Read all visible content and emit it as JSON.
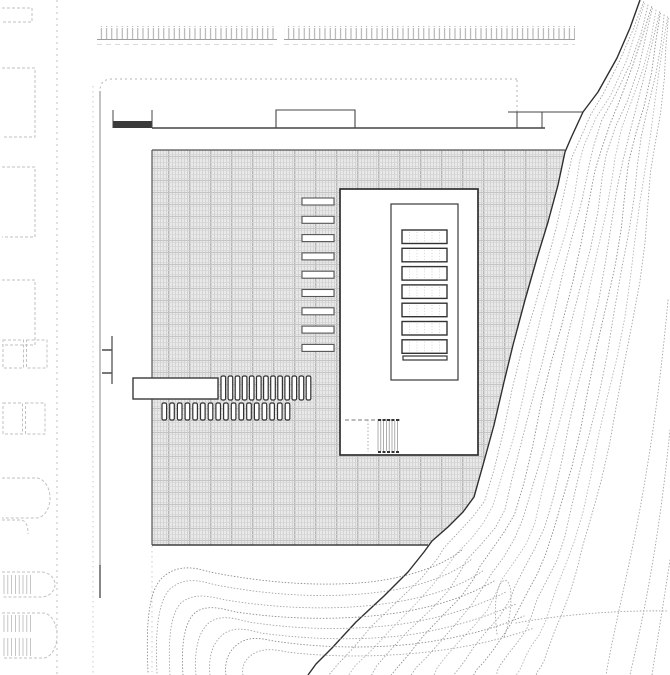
{
  "meta": {
    "label": "architectural-site-plan",
    "canvas": {
      "w": 670,
      "h": 675
    }
  },
  "colors": {
    "ink_dark": "#2f2f2f",
    "ink_mid": "#555555",
    "ink_wall": "#3a3a3a",
    "light_line": "#c2c2c2",
    "faint_line": "#cfcfcf",
    "edge_line": "#8f8f8f",
    "contour": "#a4a4a4",
    "contour_dark": "#8d8d8d",
    "contour_light": "#b4b4b4",
    "hatch_bg": "#e9e9e9",
    "hatch_line": "#cfcfcf",
    "hatch_accent": "#b7b7b7",
    "hatch_h": "#d6d6d6",
    "hatch_hacc": "#c4c4c4",
    "white": "#ffffff",
    "band_tick": "#9f9f9f",
    "stair_line": "#8a8a8a"
  },
  "drawing": {
    "street_lines": [
      {
        "name": "street-curb-line",
        "x": 57,
        "y1": 0,
        "y2": 675,
        "dash": "2 4",
        "color": "#c0c0c0",
        "w": 1
      },
      {
        "name": "street-inner-line",
        "x": 93,
        "y1": 86,
        "y2": 675,
        "dash": "1.5 3.5",
        "color": "#c6c6c6",
        "w": 0.9
      },
      {
        "name": "site-edge-line",
        "x": 100,
        "y1": 91,
        "y2": 598,
        "dash": "",
        "color": "#8f8f8f",
        "w": 1.1
      },
      {
        "name": "site-edge-line-dark-end",
        "x": 100,
        "y1": 565,
        "y2": 598,
        "dash": "",
        "color": "#6a6a6a",
        "w": 1.6
      },
      {
        "name": "plaza-edge-extension-line",
        "x": 152,
        "y1": 546,
        "y2": 672,
        "dash": "1.5 3.5",
        "color": "#c4c4c4",
        "w": 0.9
      }
    ],
    "boundary": {
      "corner_path": "M517,79 L112,79 Q100,79 100,91",
      "stub_x": 517,
      "stub_y1": 80,
      "stub_y2": 112
    },
    "tick_band": {
      "y1": 26,
      "y2": 39,
      "baseline_y": 39.5,
      "dash_y": 44.5,
      "segments": [
        [
          97,
          277
        ],
        [
          284,
          575
        ]
      ]
    },
    "lots": [
      {
        "kind": "open-rect",
        "x": 2,
        "y": 8,
        "w": 30,
        "h": 14
      },
      {
        "kind": "open-rect",
        "x": 2,
        "y": 68,
        "w": 33,
        "h": 69
      },
      {
        "kind": "open-rect",
        "x": 2,
        "y": 167,
        "w": 33,
        "h": 70
      },
      {
        "kind": "open-rect",
        "x": 2,
        "y": 280,
        "w": 33,
        "h": 65
      },
      {
        "kind": "pair",
        "x": 3,
        "y": 340,
        "w": 44,
        "h": 28
      },
      {
        "kind": "pair",
        "x": 3,
        "y": 403,
        "w": 42,
        "h": 31
      },
      {
        "kind": "dshape",
        "x": 2,
        "y": 478,
        "w": 48,
        "h": 40
      },
      {
        "kind": "arc",
        "x": 2,
        "y": 520,
        "w": 26,
        "h": 14
      },
      {
        "kind": "dshape-hatched",
        "x": 2,
        "y": 572,
        "w": 53,
        "h": 25
      },
      {
        "kind": "dshape-hatched2",
        "x": 2,
        "y": 613,
        "w": 55,
        "h": 45
      }
    ],
    "ladder_marker": {
      "x1": 102,
      "x2": 112,
      "ytop": 336,
      "ybot": 384,
      "rungs": [
        350,
        373
      ]
    },
    "wall": {
      "y": 128,
      "x1": 152,
      "x2": 545,
      "bar": {
        "x1": 113,
        "x2": 152,
        "y1": 121,
        "y2": 128
      },
      "ticks": [
        {
          "x": 113,
          "y1": 110,
          "y2": 128
        },
        {
          "x": 152,
          "y1": 110,
          "y2": 128
        }
      ]
    },
    "canopy1": {
      "x1": 276,
      "x2": 355,
      "ytop": 110,
      "ybase": 128
    },
    "canopy2": {
      "y": 112,
      "x1": 508,
      "x2": 583,
      "ticks": [
        517,
        542
      ],
      "tick_y2": 128
    },
    "plaza_points": [
      [
        152,
        150
      ],
      [
        565,
        150
      ],
      [
        558,
        185
      ],
      [
        548,
        222
      ],
      [
        537,
        258
      ],
      [
        525,
        300
      ],
      [
        513,
        345
      ],
      [
        504,
        382
      ],
      [
        494,
        425
      ],
      [
        483,
        465
      ],
      [
        474,
        497
      ],
      [
        463,
        512
      ],
      [
        448,
        527
      ],
      [
        432,
        541
      ],
      [
        428,
        545
      ],
      [
        152,
        545
      ]
    ],
    "louvers": {
      "x": 302,
      "w": 32,
      "h": 7,
      "y0": 198,
      "pitch": 18.3,
      "count": 9
    },
    "pier": {
      "x": 133,
      "y": 378,
      "w": 85,
      "h": 21
    },
    "stall_rows": [
      {
        "x0": 221,
        "pitch": 7.1,
        "count": 13,
        "y": 376,
        "h": 24,
        "w": 4.6
      },
      {
        "x0": 162,
        "pitch": 7.7,
        "count": 17,
        "y": 403,
        "h": 17,
        "w": 4.6
      }
    ],
    "building": {
      "outer": {
        "x": 340,
        "y": 189,
        "w": 138,
        "h": 266
      },
      "inner": {
        "x": 391,
        "y": 204,
        "w": 67,
        "h": 176
      },
      "skylights": {
        "x": 402,
        "w": 45,
        "h": 13.5,
        "y0": 230,
        "pitch": 18.3,
        "count": 7,
        "mullions": 5
      },
      "bar": {
        "x": 403,
        "y": 356,
        "w": 44,
        "h": 4
      },
      "stair": {
        "dash_y": 420,
        "dash_x1": 345,
        "dash_x2": 400,
        "vline_x": 368,
        "block": {
          "x1": 378,
          "x2": 400,
          "y1": 420,
          "y2": 452,
          "step": 2.8
        }
      }
    },
    "cliff_edge": [
      [
        640,
        0
      ],
      [
        630,
        28
      ],
      [
        617,
        58
      ],
      [
        598,
        92
      ],
      [
        583,
        112
      ],
      [
        571,
        138
      ],
      [
        565,
        152
      ],
      [
        558,
        185
      ],
      [
        548,
        222
      ],
      [
        537,
        258
      ],
      [
        525,
        300
      ],
      [
        513,
        345
      ],
      [
        504,
        382
      ],
      [
        494,
        425
      ],
      [
        483,
        465
      ],
      [
        474,
        497
      ],
      [
        463,
        512
      ],
      [
        448,
        527
      ],
      [
        432,
        541
      ],
      [
        424,
        552
      ],
      [
        408,
        572
      ],
      [
        384,
        596
      ],
      [
        356,
        622
      ],
      [
        332,
        648
      ],
      [
        316,
        664
      ],
      [
        308,
        675
      ]
    ],
    "contour_outer": [
      [
        672,
        20
      ],
      [
        670,
        48
      ],
      [
        668,
        80
      ],
      [
        665,
        115
      ],
      [
        662,
        145
      ],
      [
        659,
        175
      ],
      [
        656,
        210
      ],
      [
        652,
        248
      ],
      [
        647,
        288
      ],
      [
        641,
        330
      ],
      [
        634,
        372
      ],
      [
        626,
        412
      ],
      [
        618,
        450
      ],
      [
        610,
        486
      ],
      [
        602,
        520
      ],
      [
        594,
        550
      ],
      [
        587,
        576
      ],
      [
        580,
        598
      ],
      [
        574,
        618
      ],
      [
        569,
        634
      ],
      [
        565,
        648
      ],
      [
        562,
        656
      ],
      [
        560,
        664
      ],
      [
        559,
        669
      ],
      [
        558,
        673
      ],
      [
        558,
        675
      ]
    ],
    "contour_band_count": 11,
    "contour_hooks": [
      "M148,672 C146,625 148,592 162,578 C178,563 196,568 210,572 C250,580 310,588 370,582 C410,577 442,566 462,550",
      "M157,673 C155,632 158,601 170,589 C185,576 201,581 216,585 C258,593 318,600 380,592 C420,587 452,575 472,559",
      "M170,675 C168,641 170,613 182,602 C196,592 211,597 226,600 C268,607 330,612 390,603 C430,597 462,586 484,570",
      "M183,675 C181,646 184,621 196,612 C208,604 223,609 236,612 C276,618 336,622 396,613 C436,607 468,596 494,581",
      "M196,675 C194,651 198,631 210,622 C222,614 236,619 249,622 C287,628 342,632 402,624 C442,618 476,607 506,592",
      "M210,675 C208,656 213,641 225,633 C237,626 249,630 261,633 C297,638 350,642 408,635 C448,629 484,618 516,604",
      "M226,675 C224,661 229,649 241,642 C252,636 263,639 274,641 C307,646 357,650 413,644 C453,639 492,630 524,616",
      "M243,675 C241,665 247,656 257,652 C267,648 277,650 287,652 C319,656 364,658 418,653 C458,649 498,641 534,628"
    ],
    "contour_extras": [
      "M497,634 C494,611 495,592 501,583 C507,576 511,584 511,597 C511,612 508,626 504,638",
      "M516,623 C560,615 615,610 668,611",
      "M668,300 C660,390 648,470 634,540 C622,598 612,640 606,675",
      "M670,430 C663,500 654,560 643,615 C637,645 633,661 630,675",
      "M670,560 C664,600 658,636 652,675"
    ]
  }
}
